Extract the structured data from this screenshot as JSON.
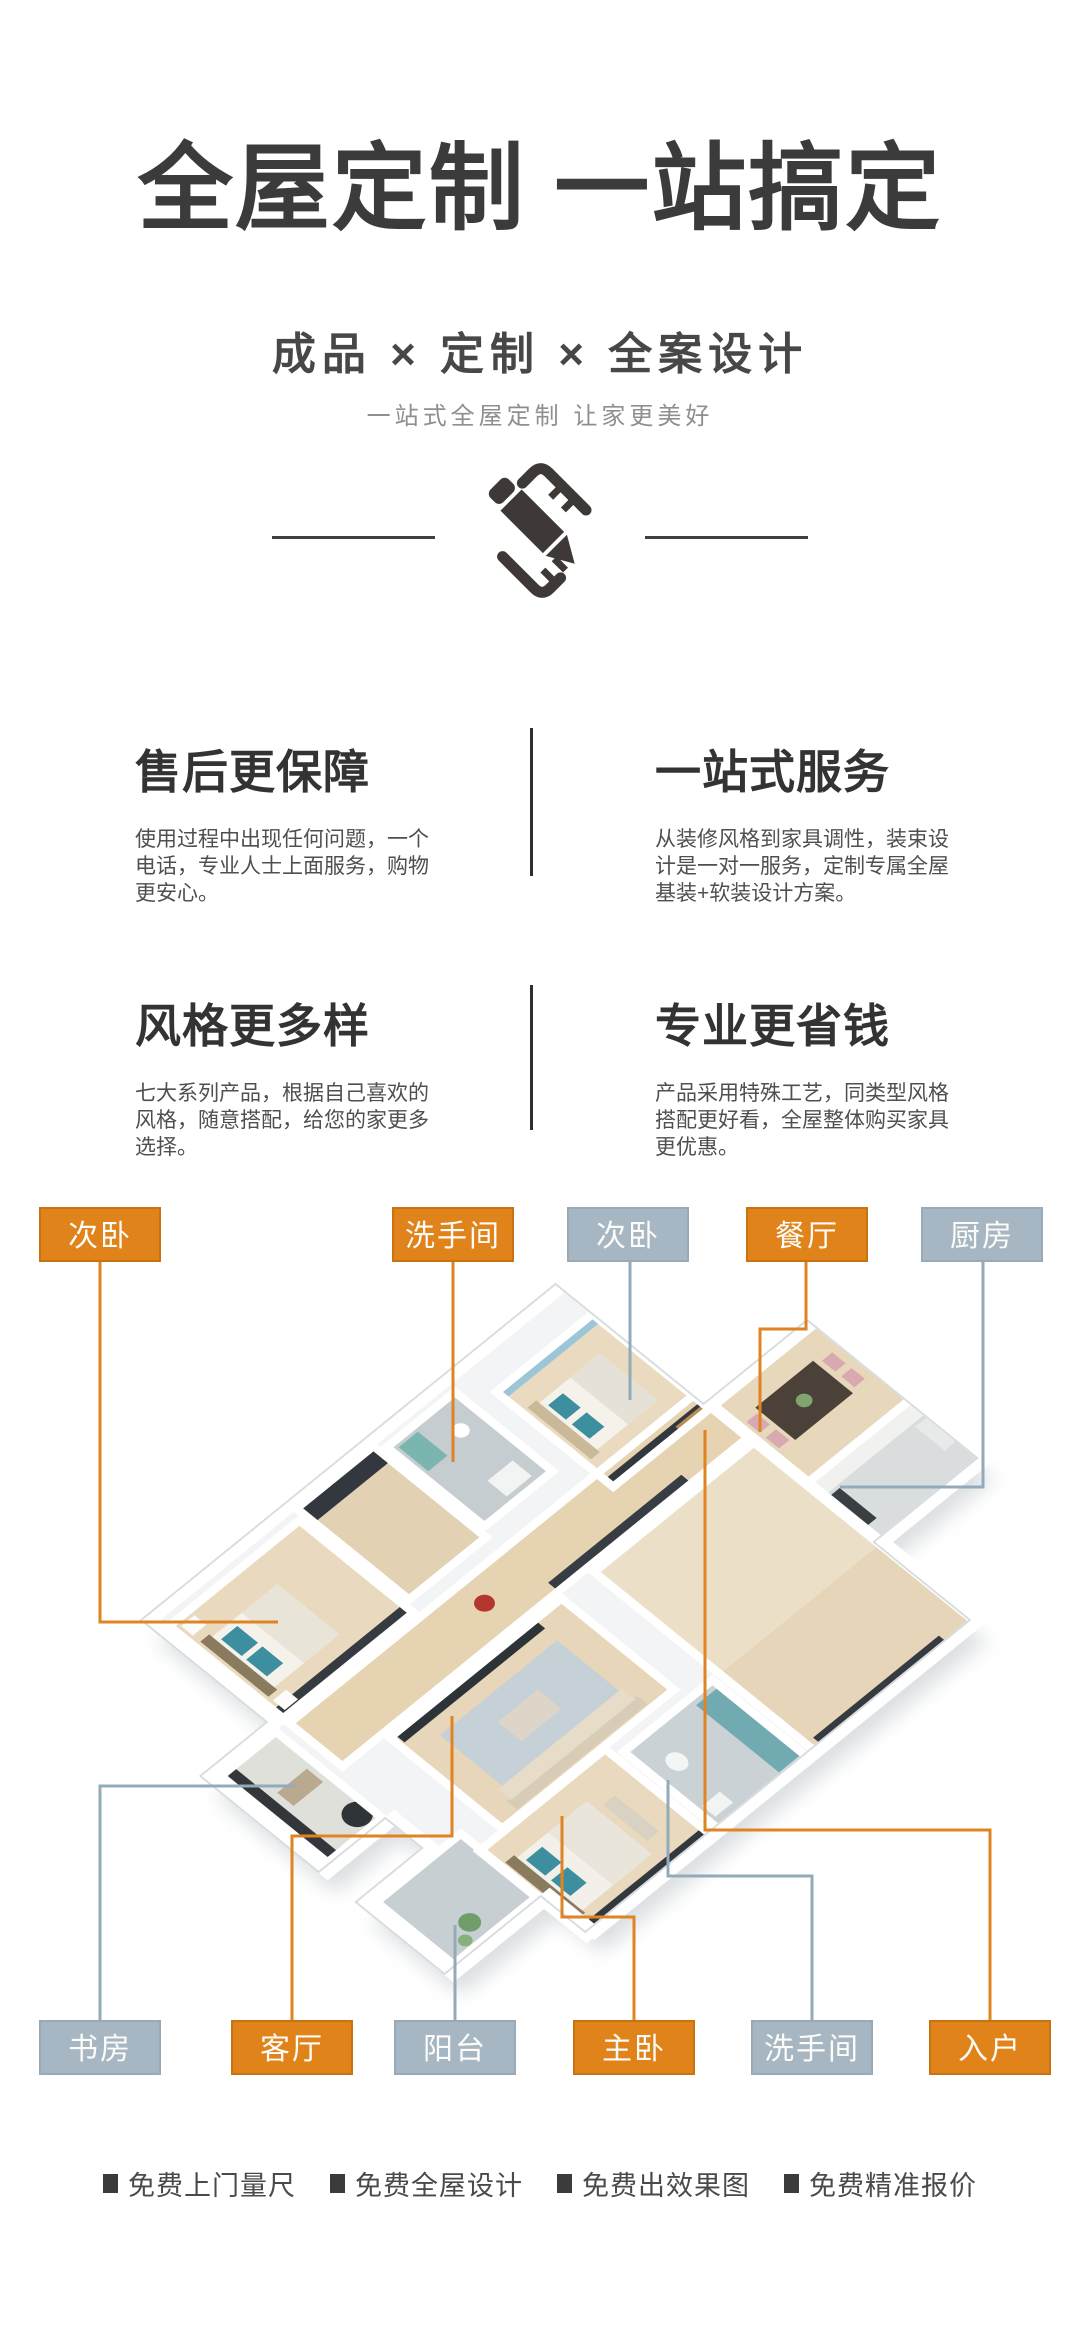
{
  "hero": {
    "title": "全屋定制 一站搞定",
    "subtitle": "成品 × 定制 × 全案设计",
    "tagline": "一站式全屋定制 让家更美好",
    "icon": "pencil-and-ruler-icon"
  },
  "features": [
    {
      "title": "售后更保障",
      "body": "使用过程中出现任何问题，一个电话，专业人士上面服务，购物更安心。"
    },
    {
      "title": "一站式服务",
      "body": "从装修风格到家具调性，装束设计是一对一服务，定制专属全屋基装+软装设计方案。"
    },
    {
      "title": "风格更多样",
      "body": "七大系列产品，根据自己喜欢的风格，随意搭配，给您的家更多选择。"
    },
    {
      "title": "专业更省钱",
      "body": "产品采用特殊工艺，同类型风格搭配更好看，全屋整体购买家具更优惠。"
    }
  ],
  "floorplan": {
    "top_labels": [
      {
        "text": "次卧",
        "color": "orange"
      },
      {
        "text": "洗手间",
        "color": "orange"
      },
      {
        "text": "次卧",
        "color": "gray"
      },
      {
        "text": "餐厅",
        "color": "orange"
      },
      {
        "text": "厨房",
        "color": "gray"
      }
    ],
    "bottom_labels": [
      {
        "text": "书房",
        "color": "gray"
      },
      {
        "text": "客厅",
        "color": "orange"
      },
      {
        "text": "阳台",
        "color": "gray"
      },
      {
        "text": "主卧",
        "color": "orange"
      },
      {
        "text": "洗手间",
        "color": "gray"
      },
      {
        "text": "入户",
        "color": "orange"
      }
    ],
    "colors": {
      "label_orange": "#e0831a",
      "label_gray": "#a6b6c2",
      "line_orange": "#e08322",
      "line_gray": "#93aabb"
    }
  },
  "services": [
    "免费上门量尺",
    "免费全屋设计",
    "免费出效果图",
    "免费精准报价"
  ]
}
